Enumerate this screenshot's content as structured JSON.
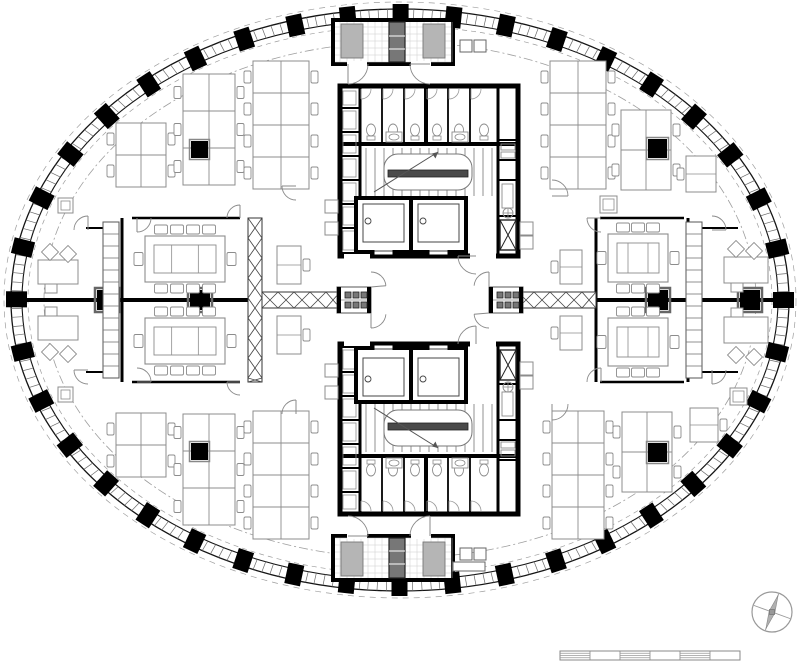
{
  "meta": {
    "type": "architectural-floor-plan",
    "subject": "Elliptical office tower typical floor plan with twin central cores, open-plan desks and meeting rooms",
    "visible_text": []
  },
  "palette": {
    "ink": "#000000",
    "wall": "#141414",
    "line": "#555555",
    "furn": "#8c8c8c",
    "soft": "#9a9a9a",
    "dash": "#9e9e9e",
    "tile": "#cccccc",
    "stipple": "#b5b5b5",
    "dark_fill": "#4a4a4a",
    "white": "#ffffff"
  },
  "canvas": {
    "w": 800,
    "h": 668
  },
  "facade": {
    "cx": 400,
    "cy": 300,
    "rx": 389,
    "ry": 291,
    "band": 11,
    "column_count": 40,
    "column_w": 16,
    "column_h": 21,
    "mullion_step": 9,
    "outer_dash_offset": 7,
    "inner_dash_offset": -17,
    "walk_dash_offset": -33
  },
  "axis": {
    "y": 300,
    "width": 4,
    "segments": [
      [
        11,
        337
      ],
      [
        523,
        789
      ]
    ],
    "columns": [
      {
        "x": 107,
        "s": 24
      },
      {
        "x": 200,
        "s": 24
      },
      {
        "x": 658,
        "s": 24
      },
      {
        "x": 750,
        "s": 24
      }
    ]
  },
  "walls": [
    [
      122,
      218,
      122,
      382,
      3
    ],
    [
      596,
      218,
      596,
      382,
      3
    ],
    [
      688,
      218,
      688,
      382,
      3
    ],
    [
      132,
      218,
      240,
      218,
      2.5
    ],
    [
      132,
      382,
      240,
      382,
      2.5
    ],
    [
      600,
      218,
      684,
      218,
      2.5
    ],
    [
      600,
      382,
      684,
      382,
      2.5
    ],
    [
      86,
      228,
      103,
      228,
      2
    ],
    [
      86,
      372,
      103,
      372,
      2
    ],
    [
      702,
      228,
      738,
      228,
      2
    ],
    [
      702,
      372,
      738,
      372,
      2
    ]
  ],
  "braces": {
    "vertical": [
      {
        "x": 248,
        "y": 218,
        "w": 14,
        "h": 164,
        "step": 20
      }
    ],
    "horizontal": [
      {
        "x": 262,
        "y": 292,
        "w": 78,
        "h": 16,
        "step": 16
      },
      {
        "x": 518,
        "y": 292,
        "w": 78,
        "h": 16,
        "step": 16
      }
    ]
  },
  "mullion_strips": [
    {
      "x": 103,
      "y": 222,
      "w": 16,
      "h": 156,
      "step": 12
    },
    {
      "x": 686,
      "y": 222,
      "w": 16,
      "h": 156,
      "step": 12
    }
  ],
  "cores": [
    {
      "x": 340,
      "y": 86,
      "w": 178,
      "h": 170,
      "flip": false
    },
    {
      "x": 340,
      "y": 344,
      "w": 178,
      "h": 170,
      "flip": true
    }
  ],
  "core_template": {
    "wall": 5,
    "wc_h": 58,
    "wc_x0": 20,
    "wc_x1": 158,
    "partitions": [
      42,
      64,
      86,
      108,
      130
    ],
    "thick_partition": 86,
    "left_cell_x": 20,
    "left_dividers": [
      22,
      46,
      70,
      94,
      118,
      142
    ],
    "right_cell_x": 158,
    "right_dividers": [
      54,
      74,
      94,
      130
    ],
    "stair": {
      "x0": 22,
      "y0": 62,
      "x1": 156,
      "y1": 110,
      "tread": 9
    },
    "lifts": [
      {
        "x": 16,
        "y": 112,
        "w": 55,
        "h": 54
      },
      {
        "x": 71,
        "y": 112,
        "w": 55,
        "h": 54
      }
    ]
  },
  "service_rooms": [
    {
      "x": 333,
      "y": 20,
      "w": 120,
      "h": 44,
      "flip": false
    },
    {
      "x": 333,
      "y": 536,
      "w": 120,
      "h": 44,
      "flip": true
    }
  ],
  "turnstiles": [
    {
      "x": 337,
      "y": 287,
      "w": 34,
      "h": 26
    },
    {
      "x": 489,
      "y": 287,
      "w": 34,
      "h": 26
    }
  ],
  "furniture": {
    "benches": [
      {
        "x": 116,
        "y": 123,
        "cols": 2,
        "rows": 2,
        "dw": 25,
        "dh": 32
      },
      {
        "x": 183,
        "y": 74,
        "cols": 2,
        "rows": 3,
        "dw": 26,
        "dh": 37
      },
      {
        "x": 253,
        "y": 61,
        "cols": 2,
        "rows": 4,
        "dw": 28,
        "dh": 32
      },
      {
        "x": 550,
        "y": 61,
        "cols": 2,
        "rows": 4,
        "dw": 28,
        "dh": 32
      },
      {
        "x": 621,
        "y": 110,
        "cols": 2,
        "rows": 2,
        "dw": 25,
        "dh": 40
      },
      {
        "x": 116,
        "y": 413,
        "cols": 2,
        "rows": 2,
        "dw": 25,
        "dh": 32
      },
      {
        "x": 183,
        "y": 414,
        "cols": 2,
        "rows": 3,
        "dw": 26,
        "dh": 37
      },
      {
        "x": 253,
        "y": 411,
        "cols": 2,
        "rows": 4,
        "dw": 28,
        "dh": 32
      },
      {
        "x": 552,
        "y": 411,
        "cols": 2,
        "rows": 4,
        "dw": 26,
        "dh": 32
      },
      {
        "x": 622,
        "y": 412,
        "cols": 2,
        "rows": 2,
        "dw": 25,
        "dh": 40
      }
    ],
    "bench_columns": [
      {
        "x": 191,
        "y": 141,
        "s": 17
      },
      {
        "x": 648,
        "y": 139,
        "s": 19
      },
      {
        "x": 191,
        "y": 443,
        "s": 17
      },
      {
        "x": 648,
        "y": 443,
        "s": 19
      }
    ],
    "singles": [
      {
        "x": 686,
        "y": 156,
        "w": 30,
        "h": 36,
        "tab": "left"
      },
      {
        "x": 690,
        "y": 408,
        "w": 28,
        "h": 34,
        "tab": "right"
      },
      {
        "x": 277,
        "y": 246,
        "w": 24,
        "h": 38,
        "tab": "right"
      },
      {
        "x": 277,
        "y": 316,
        "w": 24,
        "h": 38,
        "tab": "right"
      },
      {
        "x": 560,
        "y": 250,
        "w": 22,
        "h": 34,
        "tab": "left"
      },
      {
        "x": 560,
        "y": 316,
        "w": 22,
        "h": 34,
        "tab": "left"
      }
    ],
    "exec_desks": [
      {
        "x": 38,
        "y": 260,
        "w": 40,
        "h": 24,
        "side": "above"
      },
      {
        "x": 38,
        "y": 316,
        "w": 40,
        "h": 24,
        "side": "below"
      },
      {
        "x": 724,
        "y": 257,
        "w": 44,
        "h": 26,
        "side": "above"
      },
      {
        "x": 724,
        "y": 317,
        "w": 44,
        "h": 26,
        "side": "below"
      }
    ],
    "conference_tables": [
      {
        "x": 145,
        "y": 236,
        "w": 80,
        "h": 46,
        "top": 4,
        "bottom": 4,
        "left": 1,
        "right": 1
      },
      {
        "x": 145,
        "y": 318,
        "w": 80,
        "h": 46,
        "top": 4,
        "bottom": 4,
        "left": 1,
        "right": 1
      },
      {
        "x": 608,
        "y": 234,
        "w": 60,
        "h": 48,
        "top": 3,
        "bottom": 3,
        "left": 1,
        "right": 1
      },
      {
        "x": 608,
        "y": 318,
        "w": 60,
        "h": 48,
        "top": 3,
        "bottom": 3,
        "left": 1,
        "right": 1
      }
    ],
    "storage": [
      {
        "x": 325,
        "y": 200
      },
      {
        "x": 325,
        "y": 222
      },
      {
        "x": 520,
        "y": 222
      },
      {
        "x": 520,
        "y": 236
      },
      {
        "x": 325,
        "y": 364
      },
      {
        "x": 325,
        "y": 386
      },
      {
        "x": 520,
        "y": 362
      },
      {
        "x": 520,
        "y": 376
      }
    ],
    "storage_size": 13,
    "lockers": [
      {
        "x": 460,
        "y": 40
      },
      {
        "x": 474,
        "y": 40
      },
      {
        "x": 460,
        "y": 548
      },
      {
        "x": 474,
        "y": 548
      }
    ],
    "locker_size": 12,
    "cabinets": [
      {
        "x": 453,
        "y": 562,
        "w": 32,
        "h": 9
      }
    ],
    "planters": [
      {
        "x": 600,
        "y": 196,
        "s": 17
      },
      {
        "x": 730,
        "y": 388,
        "s": 17
      },
      {
        "x": 58,
        "y": 198,
        "s": 15
      },
      {
        "x": 58,
        "y": 387,
        "s": 15
      }
    ]
  },
  "arcs": [
    {
      "cx": 348,
      "cy": 64,
      "r": 20,
      "a0": 0,
      "a1": 90
    },
    {
      "cx": 430,
      "cy": 64,
      "r": 20,
      "a0": 90,
      "a1": 180
    },
    {
      "cx": 348,
      "cy": 536,
      "r": 20,
      "a0": 270,
      "a1": 360
    },
    {
      "cx": 430,
      "cy": 536,
      "r": 20,
      "a0": 180,
      "a1": 270
    },
    {
      "cx": 371,
      "cy": 287,
      "r": 15,
      "a0": 270,
      "a1": 355
    },
    {
      "cx": 371,
      "cy": 313,
      "r": 15,
      "a0": 5,
      "a1": 90
    },
    {
      "cx": 489,
      "cy": 287,
      "r": 15,
      "a0": 185,
      "a1": 270
    },
    {
      "cx": 489,
      "cy": 313,
      "r": 15,
      "a0": 90,
      "a1": 175
    },
    {
      "cx": 137,
      "cy": 218,
      "r": 14,
      "a0": 0,
      "a1": 90
    },
    {
      "cx": 137,
      "cy": 382,
      "r": 14,
      "a0": 270,
      "a1": 360
    },
    {
      "cx": 240,
      "cy": 218,
      "r": 13,
      "a0": 180,
      "a1": 270
    },
    {
      "cx": 240,
      "cy": 382,
      "r": 13,
      "a0": 90,
      "a1": 180
    },
    {
      "cx": 601,
      "cy": 218,
      "r": 14,
      "a0": 90,
      "a1": 180
    },
    {
      "cx": 601,
      "cy": 382,
      "r": 14,
      "a0": 180,
      "a1": 270
    },
    {
      "cx": 296,
      "cy": 186,
      "r": 14,
      "a0": 90,
      "a1": 180
    },
    {
      "cx": 296,
      "cy": 414,
      "r": 14,
      "a0": 180,
      "a1": 270
    },
    {
      "cx": 552,
      "cy": 196,
      "r": 16,
      "a0": 270,
      "a1": 360
    },
    {
      "cx": 552,
      "cy": 404,
      "r": 16,
      "a0": 0,
      "a1": 90
    },
    {
      "cx": 88,
      "cy": 230,
      "r": 14,
      "a0": 180,
      "a1": 270
    },
    {
      "cx": 88,
      "cy": 370,
      "r": 14,
      "a0": 90,
      "a1": 180
    },
    {
      "cx": 712,
      "cy": 230,
      "r": 14,
      "a0": 270,
      "a1": 360
    },
    {
      "cx": 712,
      "cy": 370,
      "r": 14,
      "a0": 0,
      "a1": 90
    },
    {
      "cx": 476,
      "cy": 256,
      "r": 18,
      "a0": 90,
      "a1": 180
    },
    {
      "cx": 476,
      "cy": 344,
      "r": 18,
      "a0": 180,
      "a1": 270
    }
  ],
  "north_arrow": {
    "cx": 772,
    "cy": 612,
    "r": 20,
    "angle_deg": 20
  },
  "scale_bar": {
    "x": 560,
    "y": 651,
    "w": 180,
    "h": 9,
    "segments": 6
  }
}
